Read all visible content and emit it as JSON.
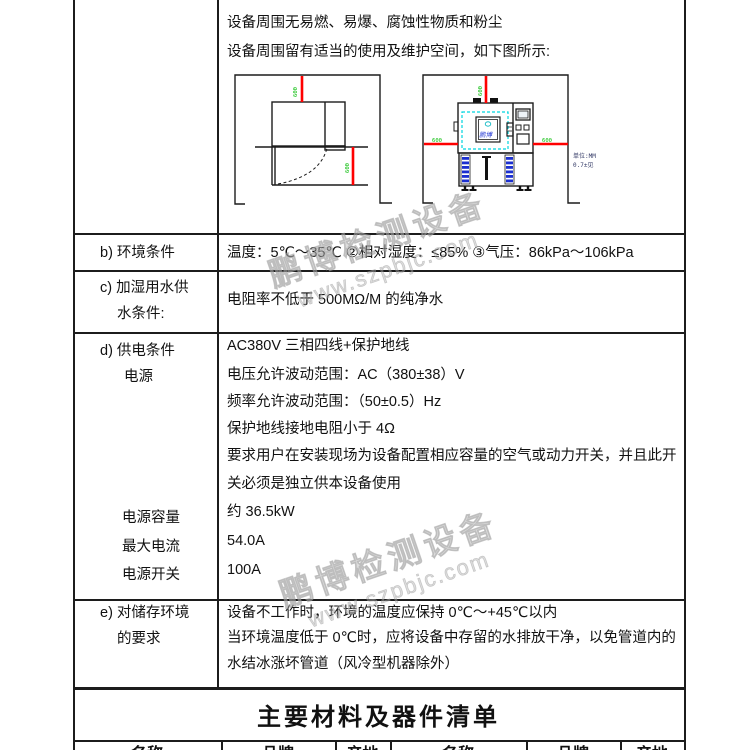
{
  "top_section": {
    "line1": "设备周围无易燃、易爆、腐蚀性物质和粉尘",
    "line2": "设备周围留有适当的使用及维护空间，如下图所示:"
  },
  "diagram": {
    "dim_label": "600",
    "unit_note_line1": "单位:MM",
    "unit_note_line2": "0.7±见",
    "logo_text": "鹏博",
    "colors": {
      "dimension_line": "#ff0000",
      "dimension_text": "#00bb00",
      "detail_cyan": "#00d5e0",
      "detail_blue": "#1b2fd0",
      "outline": "#1c1c1c"
    }
  },
  "rows": {
    "b": {
      "label1": "b) 环境条件",
      "content1": "温度：5℃～35℃ ②相对湿度：≤85% ③气压：86kPa～106kPa"
    },
    "c": {
      "label1": "c) 加湿用水供",
      "label2": "水条件:",
      "content1": "电阻率不低于 500MΩ/M 的纯净水"
    },
    "d": {
      "label1": "d) 供电条件",
      "label2": "电源",
      "label3": "电源容量",
      "label4": "最大电流",
      "label5": "电源开关",
      "line1": "AC380V  三相四线+保护地线",
      "line2": "电压允许波动范围：AC（380±38）V",
      "line3": "频率允许波动范围：（50±0.5）Hz",
      "line4": "保护地线接地电阻小于 4Ω",
      "line5": "要求用户在安装现场为设备配置相应容量的空气或动力开关，并且此开",
      "line6": "关必须是独立供本设备使用",
      "line7": "约 36.5kW",
      "line8": "54.0A",
      "line9": "100A"
    },
    "e": {
      "label1": "e) 对储存环境",
      "label2": "的要求",
      "line1": "设备不工作时，环境的温度应保持 0℃～+45℃以内",
      "line2": "当环境温度低于 0℃时，应将设备中存留的水排放干净，以免管道内的",
      "line3": "水结冰涨坏管道（风冷型机器除外）"
    }
  },
  "materials_section": {
    "title": "主要材料及器件清单",
    "columns": [
      "名称",
      "品牌",
      "产地",
      "名称",
      "品牌",
      "产地"
    ]
  },
  "watermark": {
    "line1": "鹏博检测设备",
    "line2": "www.szpbjc.com"
  }
}
